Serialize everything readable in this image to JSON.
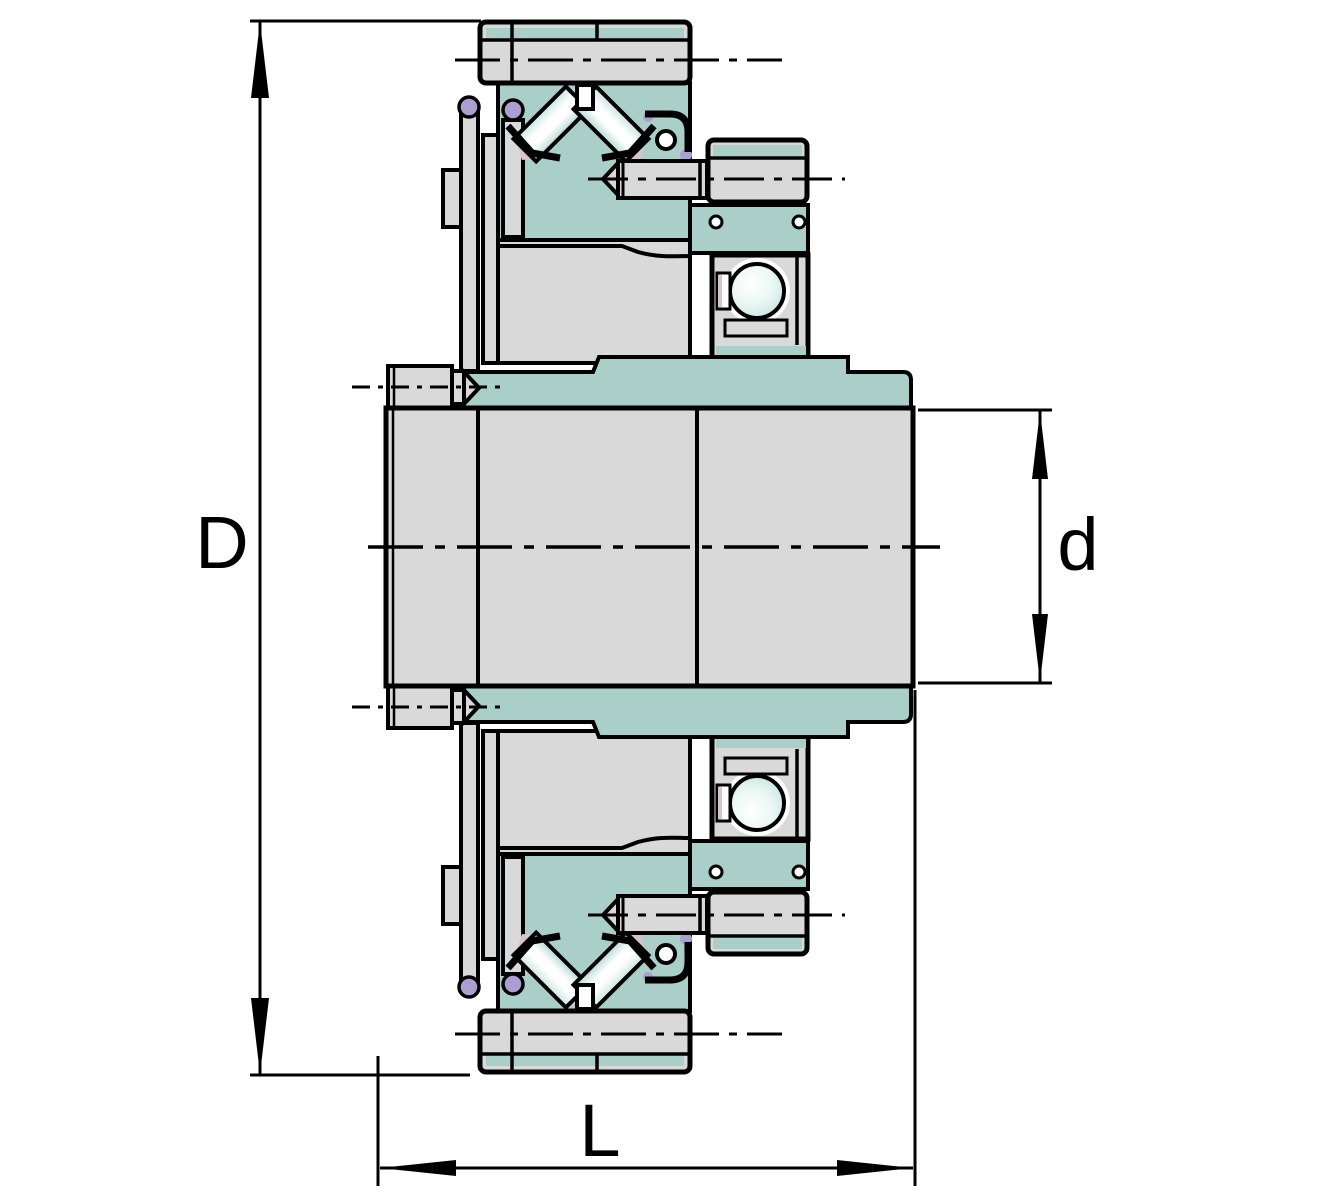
{
  "drawing": {
    "dimensions": {
      "outer_diameter": {
        "label": "D"
      },
      "bore_diameter": {
        "label": "d"
      },
      "overall_length": {
        "label": "L"
      }
    },
    "colors": {
      "background": "#ffffff",
      "outline": "#000000",
      "metal_gray": "#d9d9d9",
      "highlight_teal": "#a9cfc8",
      "accent_purple": "#ab9fd1",
      "accent_pink": "#d9c4ca"
    },
    "icons": {
      "arrow_up": "▲",
      "arrow_down": "▼",
      "arrow_left": "◀",
      "arrow_right": "▶"
    }
  }
}
